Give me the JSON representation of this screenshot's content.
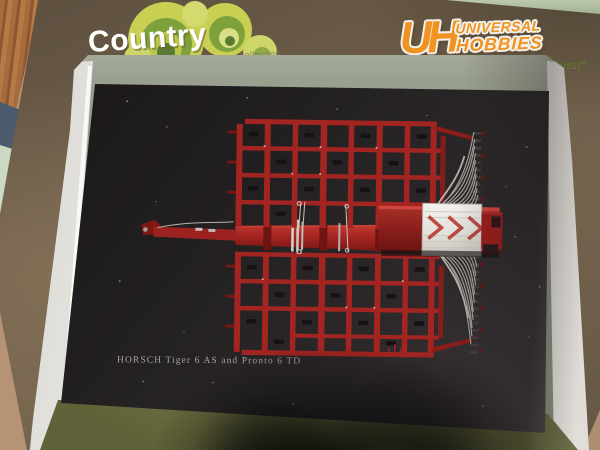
{
  "packaging": {
    "country_logo": {
      "text": "Country",
      "subtext": "collection"
    },
    "uh_logo": {
      "monogram": "UH",
      "line1": "UNIVERSAL",
      "line2": "HOBBIES",
      "tagline": "“For those who prefer the finest”"
    }
  },
  "display": {
    "caption": "HORSCH Tiger 6 AS and Pronto 6 TD"
  },
  "colors": {
    "table_tan": "#b59374",
    "wood_brown": "#a3683b",
    "surface_green": "#bcc8ad",
    "box_brown": "#6d5d49",
    "window_gray": "#9aa08f",
    "tray_white": "#f1efeb",
    "tray_base_olive": "#83864e",
    "card_black": "#221f20",
    "model_red": "#a32522",
    "model_red_dark": "#7d1815",
    "hose_gray": "#b7b3ab",
    "lid_white": "#eae7e2",
    "caption_gray": "#a7a39f",
    "logo_orange": "#f09322",
    "tagline_green": "#51631d",
    "cloud_green_light": "#c8cf52",
    "cloud_green_mid": "#7fa13c",
    "cloud_green_dark": "#5a7a33"
  }
}
